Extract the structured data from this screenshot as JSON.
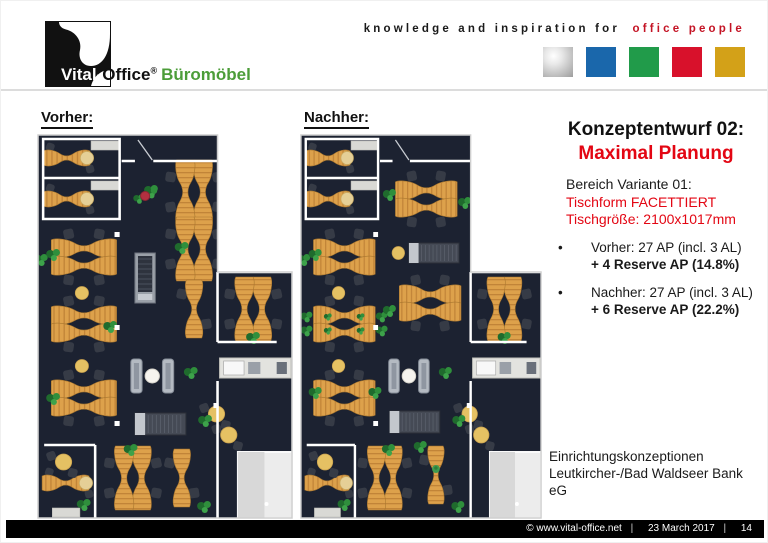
{
  "header": {
    "logo": {
      "brand_left": "Vital-",
      "brand_right": "Office",
      "reg": "®",
      "suffix": "Büromöbel"
    },
    "tagline_black": "knowledge and inspiration for",
    "tagline_red": "office people",
    "squares": [
      {
        "name": "silver-square",
        "color": "#a8a8a8"
      },
      {
        "name": "blue-square",
        "color": "#1a67ab"
      },
      {
        "name": "green-square",
        "color": "#219b4a"
      },
      {
        "name": "red-square",
        "color": "#d8112b"
      },
      {
        "name": "gold-square",
        "color": "#d3a118"
      }
    ]
  },
  "plans": {
    "left_label": "Vorher:",
    "right_label": "Nachher:"
  },
  "sidebar": {
    "title_line1": "Konzeptentwurf 02:",
    "title_line2": "Maximal Planung",
    "variant": {
      "line1": "Bereich Variante 01:",
      "line2": "Tischform FACETTIERT",
      "line3": "Tischgröße: 2100x1017mm"
    },
    "bullet_char": "•",
    "bullets": [
      {
        "normal": "Vorher: 27 AP (incl. 3 AL)",
        "bold": "+ 4 Reserve AP (14.8%)"
      },
      {
        "normal": "Nachher: 27 AP (incl. 3 AL)",
        "bold": "+ 6 Reserve AP (22.2%)"
      }
    ],
    "project": [
      "Einrichtungskonzeptionen",
      "Leutkircher-/Bad Waldseer Bank",
      "eG"
    ]
  },
  "footer": {
    "copyright": "©  www.vital-office.net",
    "date": "23 March 2017",
    "page": "14",
    "sep": "|"
  },
  "colors": {
    "plan": {
      "floor": "#1c2231",
      "wall": "#ffffff",
      "outline": "#cfcfcf",
      "desk": "#dda14b",
      "desk_stripe": "#c18438",
      "desk_edge": "#a8762e",
      "chair": "#363b46",
      "table": "#e5c163",
      "pale_table": "#e5cf96",
      "plant_dark": "#1f6b2d",
      "plant_mid": "#2f8f3c",
      "plant_light": "#3da24a",
      "sofa": "#b4bac2",
      "white_room": "#ececec"
    },
    "accent_red": "#e30613",
    "logo_green": "#4c9d39"
  }
}
